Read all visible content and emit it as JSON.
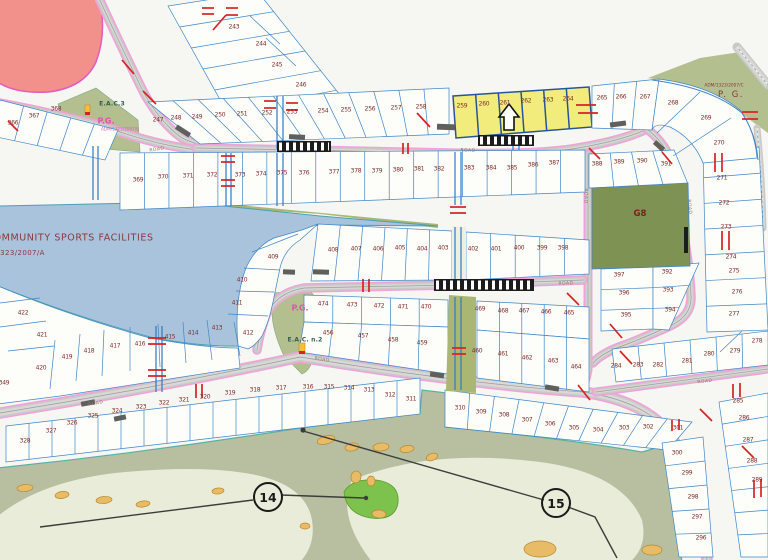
{
  "map": {
    "description": "Residential subdivision plat map with numbered lots, parks and golf course",
    "highlight": {
      "lots": [
        "259",
        "260",
        "261",
        "262",
        "263",
        "264"
      ],
      "color": "#f2ec7c"
    },
    "symbols": [
      {
        "name": "up-arrow-icon",
        "x": 509,
        "y": 117
      }
    ],
    "colors": {
      "highlight_yellow": "#f2ec7c",
      "park_green": "#7e9254",
      "water_blue": "#a9c3dd",
      "residential_pink": "#f2908c",
      "road_casing_pink": "#f0a2da",
      "lot_line_blue": "#3f86c8",
      "utility_red": "#d62222",
      "golf_green": "#b7bfa0"
    },
    "lots": [
      {
        "n": "243",
        "x": 234,
        "y": 27
      },
      {
        "n": "244",
        "x": 261,
        "y": 44
      },
      {
        "n": "245",
        "x": 277,
        "y": 65
      },
      {
        "n": "246",
        "x": 301,
        "y": 85
      },
      {
        "n": "247",
        "x": 158,
        "y": 120
      },
      {
        "n": "248",
        "x": 176,
        "y": 118
      },
      {
        "n": "249",
        "x": 197,
        "y": 117
      },
      {
        "n": "250",
        "x": 220,
        "y": 115
      },
      {
        "n": "251",
        "x": 242,
        "y": 114
      },
      {
        "n": "252",
        "x": 267,
        "y": 113
      },
      {
        "n": "253",
        "x": 292,
        "y": 112
      },
      {
        "n": "254",
        "x": 323,
        "y": 111
      },
      {
        "n": "255",
        "x": 346,
        "y": 110
      },
      {
        "n": "256",
        "x": 370,
        "y": 109
      },
      {
        "n": "257",
        "x": 396,
        "y": 108
      },
      {
        "n": "258",
        "x": 421,
        "y": 107
      },
      {
        "n": "259",
        "x": 462,
        "y": 106
      },
      {
        "n": "260",
        "x": 484,
        "y": 104
      },
      {
        "n": "261",
        "x": 505,
        "y": 103
      },
      {
        "n": "262",
        "x": 526,
        "y": 101
      },
      {
        "n": "263",
        "x": 548,
        "y": 100
      },
      {
        "n": "264",
        "x": 568,
        "y": 99
      },
      {
        "n": "265",
        "x": 602,
        "y": 98
      },
      {
        "n": "266",
        "x": 621,
        "y": 97
      },
      {
        "n": "267",
        "x": 645,
        "y": 97
      },
      {
        "n": "268",
        "x": 673,
        "y": 103
      },
      {
        "n": "269",
        "x": 706,
        "y": 118
      },
      {
        "n": "270",
        "x": 719,
        "y": 143
      },
      {
        "n": "271",
        "x": 722,
        "y": 178
      },
      {
        "n": "272",
        "x": 724,
        "y": 203
      },
      {
        "n": "273",
        "x": 726,
        "y": 227
      },
      {
        "n": "274",
        "x": 731,
        "y": 257
      },
      {
        "n": "275",
        "x": 734,
        "y": 271
      },
      {
        "n": "276",
        "x": 737,
        "y": 292
      },
      {
        "n": "277",
        "x": 734,
        "y": 314
      },
      {
        "n": "278",
        "x": 757,
        "y": 341
      },
      {
        "n": "279",
        "x": 735,
        "y": 351
      },
      {
        "n": "280",
        "x": 709,
        "y": 354
      },
      {
        "n": "281",
        "x": 687,
        "y": 361
      },
      {
        "n": "282",
        "x": 658,
        "y": 365
      },
      {
        "n": "283",
        "x": 638,
        "y": 365
      },
      {
        "n": "284",
        "x": 616,
        "y": 366
      },
      {
        "n": "285",
        "x": 738,
        "y": 401
      },
      {
        "n": "286",
        "x": 744,
        "y": 418
      },
      {
        "n": "287",
        "x": 748,
        "y": 440
      },
      {
        "n": "288",
        "x": 752,
        "y": 461
      },
      {
        "n": "289",
        "x": 757,
        "y": 480
      },
      {
        "n": "296",
        "x": 701,
        "y": 538
      },
      {
        "n": "297",
        "x": 697,
        "y": 517
      },
      {
        "n": "298",
        "x": 693,
        "y": 497
      },
      {
        "n": "299",
        "x": 687,
        "y": 473
      },
      {
        "n": "300",
        "x": 677,
        "y": 453
      },
      {
        "n": "301",
        "x": 678,
        "y": 428
      },
      {
        "n": "302",
        "x": 648,
        "y": 427
      },
      {
        "n": "303",
        "x": 624,
        "y": 428
      },
      {
        "n": "304",
        "x": 598,
        "y": 430
      },
      {
        "n": "305",
        "x": 574,
        "y": 428
      },
      {
        "n": "306",
        "x": 550,
        "y": 424
      },
      {
        "n": "307",
        "x": 527,
        "y": 420
      },
      {
        "n": "308",
        "x": 504,
        "y": 415
      },
      {
        "n": "309",
        "x": 481,
        "y": 412
      },
      {
        "n": "310",
        "x": 460,
        "y": 408
      },
      {
        "n": "311",
        "x": 411,
        "y": 399
      },
      {
        "n": "312",
        "x": 390,
        "y": 395
      },
      {
        "n": "313",
        "x": 369,
        "y": 390
      },
      {
        "n": "314",
        "x": 349,
        "y": 388
      },
      {
        "n": "315",
        "x": 329,
        "y": 387
      },
      {
        "n": "316",
        "x": 308,
        "y": 387
      },
      {
        "n": "317",
        "x": 281,
        "y": 388
      },
      {
        "n": "318",
        "x": 255,
        "y": 390
      },
      {
        "n": "319",
        "x": 230,
        "y": 393
      },
      {
        "n": "320",
        "x": 205,
        "y": 397
      },
      {
        "n": "321",
        "x": 184,
        "y": 400
      },
      {
        "n": "322",
        "x": 164,
        "y": 403
      },
      {
        "n": "323",
        "x": 141,
        "y": 407
      },
      {
        "n": "324",
        "x": 117,
        "y": 411
      },
      {
        "n": "325",
        "x": 93,
        "y": 416
      },
      {
        "n": "326",
        "x": 72,
        "y": 423
      },
      {
        "n": "327",
        "x": 51,
        "y": 431
      },
      {
        "n": "328",
        "x": 25,
        "y": 441
      },
      {
        "n": "349",
        "x": 4,
        "y": 383
      },
      {
        "n": "366",
        "x": 13,
        "y": 123
      },
      {
        "n": "367",
        "x": 34,
        "y": 116
      },
      {
        "n": "368",
        "x": 56,
        "y": 109
      },
      {
        "n": "369",
        "x": 138,
        "y": 180
      },
      {
        "n": "370",
        "x": 163,
        "y": 177
      },
      {
        "n": "371",
        "x": 188,
        "y": 176
      },
      {
        "n": "372",
        "x": 212,
        "y": 175
      },
      {
        "n": "373",
        "x": 240,
        "y": 175
      },
      {
        "n": "374",
        "x": 261,
        "y": 174
      },
      {
        "n": "375",
        "x": 282,
        "y": 173
      },
      {
        "n": "376",
        "x": 304,
        "y": 173
      },
      {
        "n": "377",
        "x": 334,
        "y": 172
      },
      {
        "n": "378",
        "x": 356,
        "y": 171
      },
      {
        "n": "379",
        "x": 377,
        "y": 171
      },
      {
        "n": "380",
        "x": 398,
        "y": 170
      },
      {
        "n": "381",
        "x": 419,
        "y": 169
      },
      {
        "n": "382",
        "x": 439,
        "y": 169
      },
      {
        "n": "383",
        "x": 469,
        "y": 168
      },
      {
        "n": "384",
        "x": 491,
        "y": 168
      },
      {
        "n": "385",
        "x": 512,
        "y": 168
      },
      {
        "n": "386",
        "x": 533,
        "y": 165
      },
      {
        "n": "387",
        "x": 554,
        "y": 163
      },
      {
        "n": "388",
        "x": 597,
        "y": 164
      },
      {
        "n": "389",
        "x": 619,
        "y": 162
      },
      {
        "n": "390",
        "x": 642,
        "y": 161
      },
      {
        "n": "391",
        "x": 666,
        "y": 164
      },
      {
        "n": "392",
        "x": 667,
        "y": 272
      },
      {
        "n": "393",
        "x": 668,
        "y": 290
      },
      {
        "n": "394",
        "x": 670,
        "y": 310
      },
      {
        "n": "395",
        "x": 626,
        "y": 315
      },
      {
        "n": "396",
        "x": 624,
        "y": 293
      },
      {
        "n": "397",
        "x": 619,
        "y": 275
      },
      {
        "n": "398",
        "x": 563,
        "y": 248
      },
      {
        "n": "399",
        "x": 542,
        "y": 248
      },
      {
        "n": "400",
        "x": 519,
        "y": 248
      },
      {
        "n": "401",
        "x": 496,
        "y": 249
      },
      {
        "n": "402",
        "x": 473,
        "y": 249
      },
      {
        "n": "403",
        "x": 443,
        "y": 248
      },
      {
        "n": "404",
        "x": 422,
        "y": 249
      },
      {
        "n": "405",
        "x": 400,
        "y": 248
      },
      {
        "n": "406",
        "x": 378,
        "y": 249
      },
      {
        "n": "407",
        "x": 356,
        "y": 249
      },
      {
        "n": "408",
        "x": 333,
        "y": 250
      },
      {
        "n": "409",
        "x": 273,
        "y": 257
      },
      {
        "n": "410",
        "x": 242,
        "y": 280
      },
      {
        "n": "411",
        "x": 237,
        "y": 303
      },
      {
        "n": "412",
        "x": 248,
        "y": 333
      },
      {
        "n": "413",
        "x": 217,
        "y": 328
      },
      {
        "n": "414",
        "x": 193,
        "y": 333
      },
      {
        "n": "415",
        "x": 170,
        "y": 337
      },
      {
        "n": "416",
        "x": 140,
        "y": 344
      },
      {
        "n": "417",
        "x": 115,
        "y": 346
      },
      {
        "n": "418",
        "x": 89,
        "y": 351
      },
      {
        "n": "419",
        "x": 67,
        "y": 357
      },
      {
        "n": "420",
        "x": 41,
        "y": 368
      },
      {
        "n": "421",
        "x": 42,
        "y": 335
      },
      {
        "n": "422",
        "x": 23,
        "y": 313
      },
      {
        "n": "456",
        "x": 328,
        "y": 333
      },
      {
        "n": "457",
        "x": 363,
        "y": 336
      },
      {
        "n": "458",
        "x": 393,
        "y": 340
      },
      {
        "n": "459",
        "x": 422,
        "y": 343
      },
      {
        "n": "460",
        "x": 477,
        "y": 351
      },
      {
        "n": "461",
        "x": 503,
        "y": 354
      },
      {
        "n": "462",
        "x": 527,
        "y": 358
      },
      {
        "n": "463",
        "x": 553,
        "y": 361
      },
      {
        "n": "464",
        "x": 576,
        "y": 367
      },
      {
        "n": "465",
        "x": 569,
        "y": 313
      },
      {
        "n": "466",
        "x": 546,
        "y": 312
      },
      {
        "n": "467",
        "x": 524,
        "y": 311
      },
      {
        "n": "468",
        "x": 503,
        "y": 311
      },
      {
        "n": "469",
        "x": 480,
        "y": 309
      },
      {
        "n": "470",
        "x": 426,
        "y": 307
      },
      {
        "n": "471",
        "x": 403,
        "y": 307
      },
      {
        "n": "472",
        "x": 379,
        "y": 306
      },
      {
        "n": "473",
        "x": 352,
        "y": 305
      },
      {
        "n": "474",
        "x": 323,
        "y": 304
      }
    ],
    "area_labels": [
      {
        "text": "E.A.C.3",
        "x": 112,
        "y": 104,
        "cls": "eac"
      },
      {
        "text": "P.G.",
        "x": 106,
        "y": 121,
        "cls": "pg"
      },
      {
        "text": "ADM/1323/2007/B",
        "x": 120,
        "y": 129,
        "cls": "ref-pink"
      },
      {
        "text": "ADM/1323/2007/C",
        "x": 724,
        "y": 86,
        "cls": "ref-dark"
      },
      {
        "text": "P. G.",
        "x": 731,
        "y": 95,
        "cls": "pg-dark"
      },
      {
        "text": "G8",
        "x": 640,
        "y": 214,
        "cls": "g8"
      },
      {
        "text": "P.G.",
        "x": 300,
        "y": 308,
        "cls": "pg"
      },
      {
        "text": "E.A.C. n.2",
        "x": 305,
        "y": 340,
        "cls": "eac"
      },
      {
        "text": "COMMUNITY SPORTS FACILITIES",
        "x": 70,
        "y": 238,
        "cls": "sports"
      },
      {
        "text": "ADM/1323/2007/A",
        "x": 10,
        "y": 253,
        "cls": "sports-ref"
      }
    ],
    "road_labels": [
      {
        "text": "ROAD",
        "x": 157,
        "y": 150,
        "rot": -9
      },
      {
        "text": "ROAD",
        "x": 468,
        "y": 151,
        "rot": 2
      },
      {
        "text": "ROAD",
        "x": 585,
        "y": 196,
        "rot": 90
      },
      {
        "text": "ROAD",
        "x": 689,
        "y": 207,
        "rot": 84
      },
      {
        "text": "ROAD",
        "x": 566,
        "y": 284,
        "rot": -2
      },
      {
        "text": "ROAD",
        "x": 322,
        "y": 360,
        "rot": 9
      },
      {
        "text": "ROAD",
        "x": 96,
        "y": 404,
        "rot": -11
      },
      {
        "text": "ROAD",
        "x": 705,
        "y": 382,
        "rot": -7
      }
    ],
    "hole_markers": [
      {
        "n": "14",
        "x": 268,
        "y": 497
      },
      {
        "n": "15",
        "x": 556,
        "y": 503
      }
    ]
  }
}
